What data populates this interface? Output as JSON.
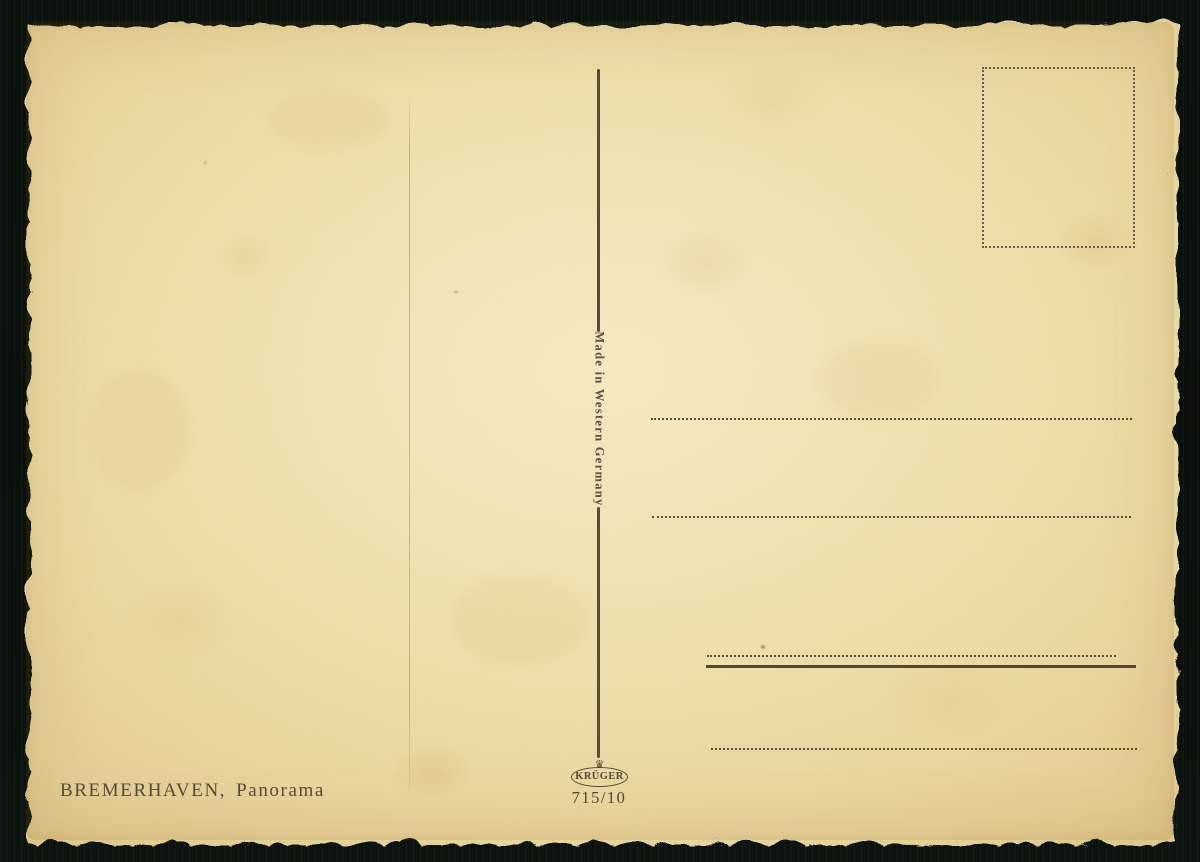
{
  "postcard": {
    "made_in": "Made in Western Germany",
    "caption": {
      "city": "BREMERHAVEN,",
      "subject": "Panorama"
    },
    "publisher": {
      "name": "KRÜGER",
      "series_number": "715/10",
      "crown_icon": "♛"
    },
    "colors": {
      "paper": "#eedfab",
      "paper_edge": "#dfc88f",
      "ink": "#54493a",
      "background": "#0b110d"
    }
  }
}
